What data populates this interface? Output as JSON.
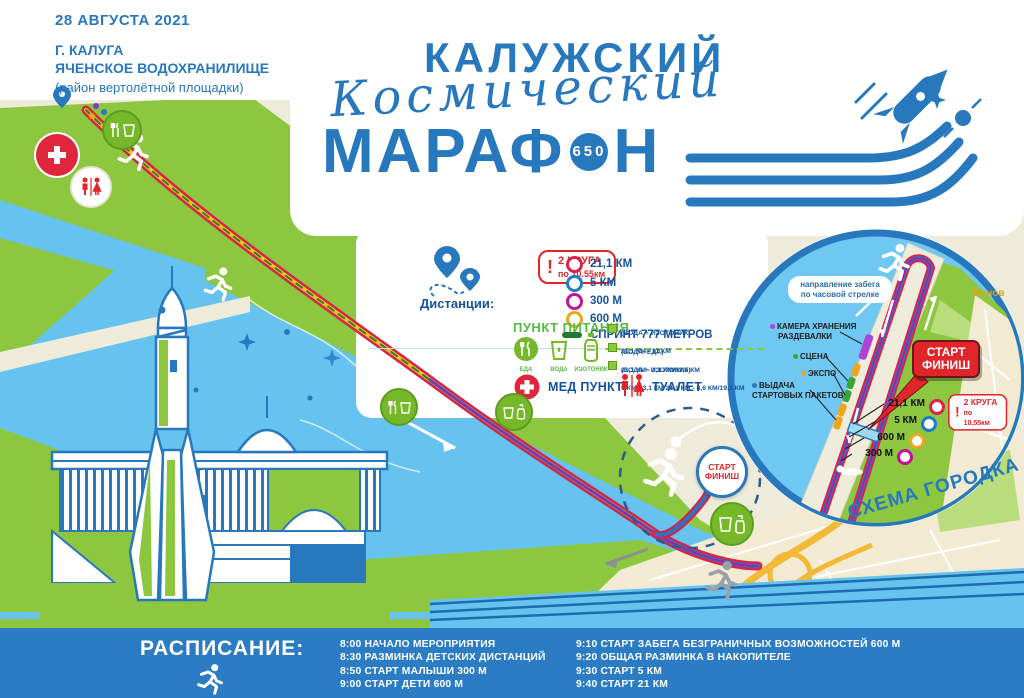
{
  "poster": {
    "date": "28 АВГУСТА 2021",
    "city": "Г. КАЛУГА",
    "venue": "ЯЧЕНСКОЕ ВОДОХРАНИЛИЩЕ",
    "venue_note": "(район вертолётной площадки)"
  },
  "logo": {
    "line1": "КАЛУЖСКИЙ",
    "line2": "Космический",
    "line3_left": "МАРАФ",
    "badge": "650",
    "line3_right": "Н"
  },
  "legend": {
    "distances_label": "Дистанции:",
    "laps": {
      "mark": "!",
      "line1": "2 КРУГА",
      "line2": "по 10.55км"
    },
    "items": [
      {
        "label": "21,1 КМ",
        "color": "#d6244b"
      },
      {
        "label": "5 КМ",
        "color": "#1f7bc8"
      },
      {
        "label": "300 М",
        "color": "#c4119b"
      },
      {
        "label": "600 М",
        "color": "#f0a51f"
      }
    ],
    "sprint_label": "СПРИНТ 777 МЕТРОВ",
    "sprint_color": "#1e7a34"
  },
  "food": {
    "title": "ПУНКТ ПИТАНИЯ",
    "stations": [
      {
        "label": "ЕДА"
      },
      {
        "label": "ВОДА"
      },
      {
        "label": "ИЗОТОНИК"
      }
    ],
    "notes": [
      {
        "head": "(ВОДА + ИЗОТОНИК)",
        "detail": "21,1 КМ - 11 КМ"
      },
      {
        "head": "(ВОДА+ЕДА)",
        "detail": "21,1 КМ - 3,1 КМ/13,6 КМ"
      },
      {
        "head": "(ВОДА + ИЗОТОНИК)",
        "detail": "5 КМ - 3,1 КМ 21,1 КМ - 8,6 КМ/19,1 КМ"
      }
    ],
    "med_label": "МЕД ПУНКТ",
    "wc_label": "ТУАЛЕТ"
  },
  "map": {
    "start_line1": "СТАРТ",
    "start_line2": "ФИНИШ"
  },
  "inset": {
    "direction_line1": "направление забега",
    "direction_line2": "по часовой стрелке",
    "camera_line1": "КАМЕРА ХРАНЕНИЯ",
    "camera_line2": "РАЗДЕВАЛКИ",
    "stage": "СЦЕНА",
    "expo": "ЭКСПО",
    "packets_line1": "ВЫДАЧА",
    "packets_line2": "СТАРТОВЫХ ПАКЕТОВ",
    "start_line1": "СТАРТ",
    "start_line2": "ФИНИШ",
    "distances": [
      {
        "label": "21,1 КМ",
        "color": "#d6244b"
      },
      {
        "label": "5 КМ",
        "color": "#1f7bc8"
      },
      {
        "label": "600 М",
        "color": "#f0a51f"
      },
      {
        "label": "300 М",
        "color": "#c4119b"
      }
    ],
    "laps": {
      "mark": "!",
      "line1": "2 КРУГА",
      "line2": "по 10.55км"
    },
    "district_label": "Иннов",
    "caption": "СХЕМА ГОРОДКА"
  },
  "schedule": {
    "title": "РАСПИСАНИЕ:",
    "col1": [
      "8:00 НАЧАЛО МЕРОПРИЯТИЯ",
      "8:30 РАЗМИНКА ДЕТСКИХ ДИСТАНЦИЙ",
      "8:50 СТАРТ МАЛЫШИ 300 М",
      "9:00 СТАРТ ДЕТИ 600 М"
    ],
    "col2": [
      "9:10  СТАРТ ЗАБЕГА БЕЗГРАНИЧНЫХ ВОЗМОЖНОСТЕЙ 600 М",
      "9:20 ОБЩАЯ РАЗМИНКА В НАКОПИТЕЛЕ",
      "9:30 СТАРТ 5 КМ",
      "9:40 СТАРТ 21 КМ"
    ]
  },
  "icons": {
    "legend_pins": "map-pin-icon",
    "med": "medical-cross-icon",
    "wc": "toilet-icon",
    "food": "food-icon",
    "water": "water-cup-icon",
    "isotonic": "bottle-icon",
    "runner": "runner-icon"
  },
  "colors": {
    "brand_blue": "#2878be",
    "navy_text": "#14549c",
    "red": "#e0262b",
    "crimson": "#d6244b",
    "magenta": "#c4119b",
    "orange": "#f0a51f",
    "route_yellow": "#f5c11e",
    "sprint_green": "#1e7a34",
    "map_green": "#8dc63f",
    "water_blue": "#66c3ef",
    "schedule_bar": "#2b7cc4",
    "station_green": "#76b82a"
  }
}
